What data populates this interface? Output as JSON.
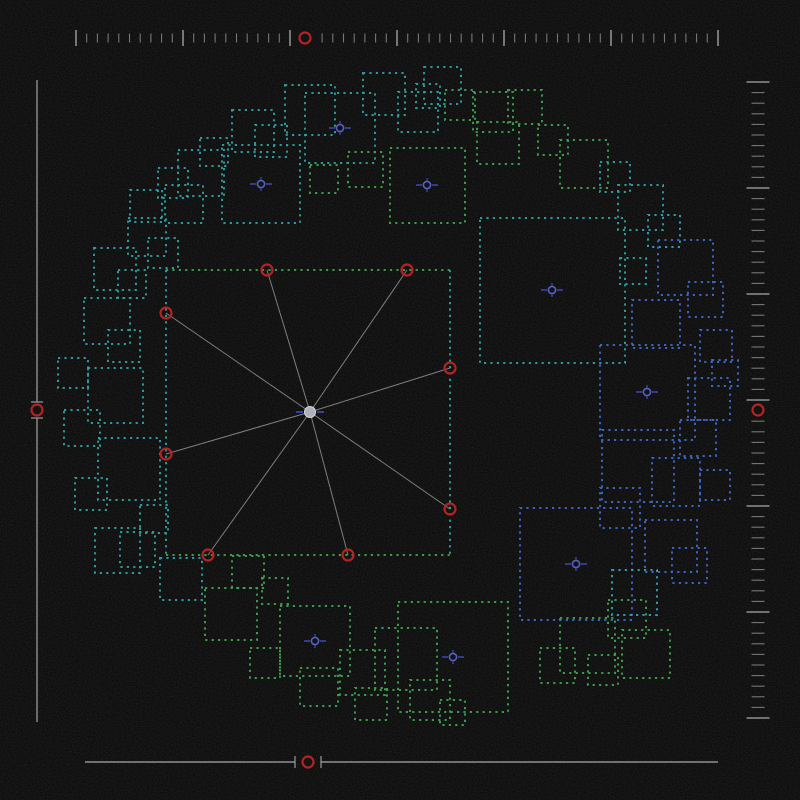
{
  "canvas": {
    "width": 800,
    "height": 800,
    "background": "#050505",
    "noise_opacity": 0.16
  },
  "palette": {
    "g": "#3fa04f",
    "t": "#2f9e9e",
    "b": "#3e68c8",
    "c": "#35a0b8",
    "red": "#b42323",
    "ruler": "#909090",
    "spoke": "#8a8a8a",
    "center_fill": "#adb2ba",
    "center_stroke": "#d2d6dc",
    "marker_ring": "#5a63b4",
    "marker_dash": "#3d43b0"
  },
  "rulers": {
    "top": {
      "kind": "ticks",
      "axis": "x",
      "at": 38,
      "start": 76,
      "end": 718,
      "tick_count": 61,
      "major_every": 10,
      "major_len": 16,
      "minor_len": 9,
      "marker_pos": 305,
      "marker_r": 5.5
    },
    "right": {
      "kind": "ticks",
      "axis": "y",
      "at": 758,
      "start": 82,
      "end": 718,
      "tick_count": 61,
      "major_every": 10,
      "major_len": 23,
      "minor_len": 13,
      "marker_pos": 410,
      "marker_r": 5.5
    },
    "left": {
      "kind": "line",
      "axis": "y",
      "at": 37,
      "start": 80,
      "end": 722,
      "marker_pos": 410,
      "marker_r": 5.5,
      "gap": 8,
      "tick_len": 12
    },
    "bottom": {
      "kind": "line",
      "axis": "x",
      "at": 762,
      "start": 85,
      "end": 718,
      "marker_pos": 308,
      "marker_r": 5.5,
      "gap": 13,
      "tick_len": 12
    }
  },
  "selection": {
    "rect": {
      "x": 166,
      "y": 270,
      "w": 284,
      "h": 285
    },
    "edge_colors": {
      "top": "g",
      "right": "t",
      "bottom": "g",
      "left": "t"
    },
    "center": {
      "x": 310,
      "y": 412,
      "r": 5.5
    },
    "handles": [
      {
        "x": 267,
        "y": 270
      },
      {
        "x": 407,
        "y": 270
      },
      {
        "x": 166,
        "y": 313
      },
      {
        "x": 450,
        "y": 368
      },
      {
        "x": 166,
        "y": 454
      },
      {
        "x": 450,
        "y": 509
      },
      {
        "x": 208,
        "y": 555
      },
      {
        "x": 348,
        "y": 555
      }
    ]
  },
  "ring_markers": [
    {
      "x": 340,
      "y": 128
    },
    {
      "x": 261,
      "y": 184
    },
    {
      "x": 427,
      "y": 185
    },
    {
      "x": 552,
      "y": 290
    },
    {
      "x": 647,
      "y": 392
    },
    {
      "x": 576,
      "y": 564
    },
    {
      "x": 453,
      "y": 657
    },
    {
      "x": 315,
      "y": 641
    }
  ],
  "squares": [
    [
      305,
      93,
      70,
      "t"
    ],
    [
      222,
      145,
      78,
      "t"
    ],
    [
      390,
      148,
      75,
      "g"
    ],
    [
      480,
      218,
      145,
      "t"
    ],
    [
      600,
      345,
      95,
      "b"
    ],
    [
      520,
      508,
      112,
      "b"
    ],
    [
      398,
      602,
      110,
      "g"
    ],
    [
      280,
      606,
      70,
      "g"
    ],
    [
      363,
      73,
      42,
      "t"
    ],
    [
      424,
      67,
      37,
      "t"
    ],
    [
      398,
      92,
      40,
      "t"
    ],
    [
      416,
      84,
      24,
      "t"
    ],
    [
      445,
      90,
      30,
      "g"
    ],
    [
      473,
      92,
      40,
      "g"
    ],
    [
      508,
      90,
      34,
      "g"
    ],
    [
      477,
      122,
      42,
      "g"
    ],
    [
      538,
      125,
      30,
      "g"
    ],
    [
      560,
      140,
      48,
      "g"
    ],
    [
      600,
      162,
      30,
      "t"
    ],
    [
      285,
      85,
      50,
      "t"
    ],
    [
      255,
      125,
      32,
      "t"
    ],
    [
      232,
      110,
      42,
      "t"
    ],
    [
      310,
      165,
      28,
      "g"
    ],
    [
      348,
      152,
      35,
      "g"
    ],
    [
      618,
      185,
      45,
      "t"
    ],
    [
      648,
      215,
      32,
      "c"
    ],
    [
      658,
      240,
      55,
      "b"
    ],
    [
      688,
      282,
      35,
      "b"
    ],
    [
      620,
      258,
      26,
      "t"
    ],
    [
      632,
      300,
      48,
      "b"
    ],
    [
      700,
      330,
      32,
      "b"
    ],
    [
      688,
      378,
      42,
      "b"
    ],
    [
      712,
      360,
      26,
      "b"
    ],
    [
      602,
      430,
      72,
      "b"
    ],
    [
      652,
      458,
      48,
      "b"
    ],
    [
      680,
      420,
      36,
      "b"
    ],
    [
      700,
      470,
      30,
      "b"
    ],
    [
      645,
      520,
      52,
      "b"
    ],
    [
      600,
      488,
      40,
      "b"
    ],
    [
      672,
      548,
      35,
      "b"
    ],
    [
      612,
      570,
      45,
      "c"
    ],
    [
      608,
      600,
      38,
      "g"
    ],
    [
      560,
      618,
      55,
      "g"
    ],
    [
      622,
      630,
      48,
      "g"
    ],
    [
      588,
      655,
      30,
      "g"
    ],
    [
      540,
      648,
      35,
      "g"
    ],
    [
      375,
      628,
      62,
      "g"
    ],
    [
      340,
      650,
      45,
      "g"
    ],
    [
      300,
      668,
      38,
      "g"
    ],
    [
      355,
      688,
      32,
      "g"
    ],
    [
      250,
      648,
      30,
      "g"
    ],
    [
      410,
      680,
      40,
      "g"
    ],
    [
      440,
      700,
      25,
      "g"
    ],
    [
      205,
      588,
      52,
      "g"
    ],
    [
      232,
      556,
      32,
      "g"
    ],
    [
      262,
      578,
      26,
      "g"
    ],
    [
      160,
      558,
      42,
      "t"
    ],
    [
      120,
      532,
      35,
      "t"
    ],
    [
      95,
      528,
      45,
      "t"
    ],
    [
      140,
      505,
      28,
      "t"
    ],
    [
      75,
      478,
      32,
      "t"
    ],
    [
      98,
      438,
      62,
      "t"
    ],
    [
      64,
      410,
      36,
      "t"
    ],
    [
      88,
      368,
      55,
      "t"
    ],
    [
      58,
      358,
      30,
      "t"
    ],
    [
      108,
      330,
      32,
      "t"
    ],
    [
      84,
      298,
      46,
      "t"
    ],
    [
      118,
      270,
      28,
      "t"
    ],
    [
      94,
      248,
      42,
      "t"
    ],
    [
      128,
      218,
      38,
      "t"
    ],
    [
      148,
      238,
      30,
      "t"
    ],
    [
      130,
      190,
      32,
      "t"
    ],
    [
      158,
      168,
      30,
      "t"
    ],
    [
      178,
      150,
      46,
      "t"
    ],
    [
      200,
      138,
      28,
      "t"
    ],
    [
      165,
      185,
      38,
      "t"
    ]
  ]
}
